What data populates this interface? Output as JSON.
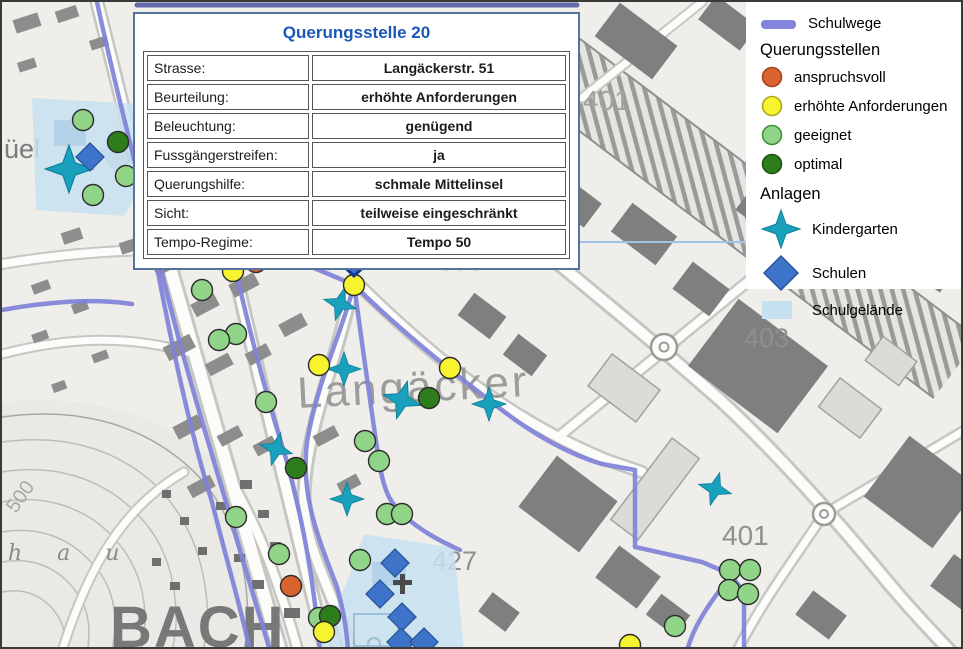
{
  "popup": {
    "title": "Querungsstelle 20",
    "rows": [
      {
        "label": "Strasse:",
        "value": "Langäckerstr. 51"
      },
      {
        "label": "Beurteilung:",
        "value": "erhöhte Anforderungen"
      },
      {
        "label": "Beleuchtung:",
        "value": "genügend"
      },
      {
        "label": "Fussgängerstreifen:",
        "value": "ja"
      },
      {
        "label": "Querungshilfe:",
        "value": "schmale Mittelinsel"
      },
      {
        "label": "Sicht:",
        "value": "teilweise eingeschränkt"
      },
      {
        "label": "Tempo-Regime:",
        "value": "Tempo 50"
      }
    ],
    "title_color": "#1a57b8",
    "border_color": "#54749e"
  },
  "legend": {
    "schulwege_label": "Schulwege",
    "schulwege_color": "#8285db",
    "querungsstellen_header": "Querungsstellen",
    "querungsstellen_items": [
      {
        "label": "anspruchsvoll",
        "fill": "#d9632f",
        "stroke": "#a8431a"
      },
      {
        "label": "erhöhte Anforderungen",
        "fill": "#f7f32e",
        "stroke": "#b0a51f"
      },
      {
        "label": "geeignet",
        "fill": "#90d488",
        "stroke": "#3f8f3a"
      },
      {
        "label": "optimal",
        "fill": "#2e7d1d",
        "stroke": "#1c5212"
      }
    ],
    "anlagen_header": "Anlagen",
    "anlagen_items": [
      {
        "label": "Kindergarten",
        "symbol": "star",
        "fill": "#18a0bd",
        "stroke": "#0e7d96"
      },
      {
        "label": "Schulen",
        "symbol": "diamond",
        "fill": "#3d74c9",
        "stroke": "#2a5699"
      },
      {
        "label": "Schulgelände",
        "symbol": "area",
        "fill": "#c5e1f2",
        "stroke": "#c5e1f2"
      }
    ]
  },
  "map": {
    "labels": [
      {
        "text": "Langäcker",
        "x": 296,
        "y": 406,
        "size": 44,
        "color": "#9c9c9c",
        "rotate": -3,
        "spacing": 3
      },
      {
        "text": "398",
        "x": 436,
        "y": 268,
        "size": 27,
        "color": "#8f8f8f"
      },
      {
        "text": "401",
        "x": 581,
        "y": 108,
        "size": 28,
        "color": "#a3a3a3"
      },
      {
        "text": "403",
        "x": 742,
        "y": 345,
        "size": 27,
        "color": "#8f8f8f"
      },
      {
        "text": "427",
        "x": 430,
        "y": 568,
        "size": 27,
        "color": "#8f8f8f"
      },
      {
        "text": "401",
        "x": 720,
        "y": 543,
        "size": 28,
        "color": "#8f8f8f"
      },
      {
        "text": "500",
        "x": 14,
        "y": 512,
        "size": 20,
        "color": "#a8a8a4",
        "rotate": -55
      },
      {
        "text": "üel",
        "x": 2,
        "y": 156,
        "size": 27,
        "color": "#7b7b7b"
      },
      {
        "text": "h a u",
        "x": 6,
        "y": 558,
        "size": 22,
        "color": "#8a8a86",
        "serif": true,
        "spacing": 14
      },
      {
        "text": "BACH",
        "x": 108,
        "y": 645,
        "size": 58,
        "color": "#787878",
        "bold": true,
        "spacing": 2
      }
    ],
    "markers": {
      "anspruchsvoll": [
        [
          247,
          246
        ],
        [
          263,
          247
        ],
        [
          254,
          260
        ],
        [
          289,
          584
        ]
      ],
      "erhoehte_anforderungen": [
        [
          231,
          269
        ],
        [
          317,
          363
        ],
        [
          448,
          366
        ],
        [
          322,
          630
        ],
        [
          628,
          643
        ],
        [
          352,
          283
        ]
      ],
      "geeignet": [
        [
          81,
          118
        ],
        [
          124,
          174
        ],
        [
          91,
          193
        ],
        [
          200,
          288
        ],
        [
          234,
          332
        ],
        [
          217,
          338
        ],
        [
          264,
          400
        ],
        [
          363,
          439
        ],
        [
          377,
          459
        ],
        [
          385,
          512
        ],
        [
          400,
          512
        ],
        [
          234,
          515
        ],
        [
          277,
          552
        ],
        [
          358,
          558
        ],
        [
          317,
          616
        ],
        [
          673,
          624
        ],
        [
          728,
          568
        ],
        [
          748,
          568
        ],
        [
          727,
          588
        ],
        [
          746,
          592
        ]
      ],
      "optimal": [
        [
          116,
          140
        ],
        [
          427,
          396
        ],
        [
          294,
          466
        ],
        [
          328,
          614
        ]
      ],
      "kindergarten": [
        [
          67,
          167,
          1.4
        ],
        [
          149,
          247,
          1
        ],
        [
          243,
          241,
          0.75
        ],
        [
          338,
          302,
          1
        ],
        [
          342,
          367,
          1
        ],
        [
          400,
          398,
          1.15
        ],
        [
          487,
          402,
          1
        ],
        [
          274,
          447,
          1
        ],
        [
          345,
          497,
          1
        ],
        [
          713,
          487,
          1
        ]
      ],
      "schulen": [
        [
          88,
          155
        ],
        [
          393,
          561
        ],
        [
          378,
          592
        ],
        [
          400,
          615
        ],
        [
          399,
          640
        ],
        [
          422,
          640
        ]
      ]
    },
    "selected_marker": {
      "x": 352,
      "y": 283
    },
    "colors": {
      "schulweg_line": "#8083d8",
      "schulgelaende": "#c8e2f0",
      "arrow_fill": "#3e70d4",
      "arrow_stroke": "#16388c",
      "dot_outline": "#2b2b2b"
    }
  }
}
